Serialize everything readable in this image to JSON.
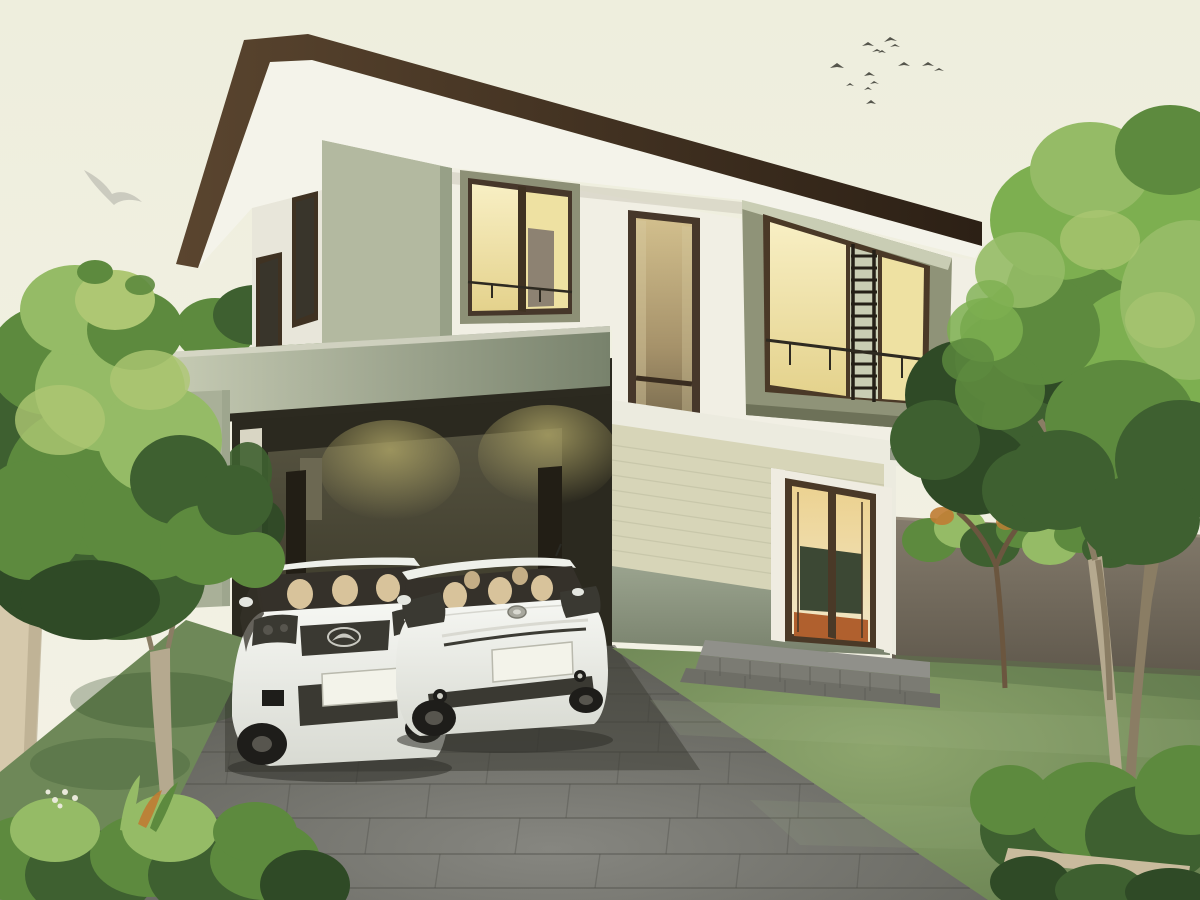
{
  "scene": {
    "type": "3d-architectural-rendering",
    "subject": "Modern two-story house exterior at dusk with carport, two white cars (Mazda SUV and Toyota Prius), block-paved driveway, front lawn, garden walls and trees; interior lights glowing warm yellow; birds flying in a pale cream sky",
    "objects": [
      "two-story-house",
      "hip-roof",
      "carport",
      "mazda-suv",
      "toyota-prius",
      "driveway",
      "front-lawn",
      "entrance-door",
      "entrance-steps",
      "boxed-window",
      "stairwell-window",
      "lit-window",
      "garden-wall",
      "boundary-wall",
      "left-tree",
      "right-trees",
      "hedges",
      "white-bird",
      "bird-flock"
    ],
    "palette": {
      "sky_base": "#f1f0e2",
      "bird_white": "#c6c6bb",
      "birds": "#3a3a33",
      "roof_brown_light": "#5a452f",
      "roof_brown_dark": "#2c2015",
      "soffit_white": "#f4f3ea",
      "wall_white": "#f1efe4",
      "wall_white_shade": "#e8e6da",
      "wall_sage": "#b3b9a0",
      "wall_sage_dark": "#97a087",
      "carport_band_light": "#c6cbb4",
      "carport_band_dark": "#78826c",
      "carport_band_fascia": "#2c2a20",
      "carport_band_cap": "#dad9c9",
      "carport_column": "#a9b098",
      "carport_interior": "#2b291f",
      "carport_back_wall": "#4b4937",
      "carport_door": "#221e15",
      "carport_window_frame": "#6c6852",
      "interior_light_wall": "#d9d6c4",
      "window_frame_dark": "#3f3222",
      "window_glass_dark": "#39352b",
      "window_frame_olive": "#8d9076",
      "window_box_sage": "#8f9378",
      "window_box_light": "#c9cdb4",
      "window_box_shade": "#6d7158",
      "window_glass_lit": "#eee1a2",
      "window_glass_lit_bright": "#f6ecc0",
      "window_interior_door": "#8d8272",
      "trellis_dark": "#241f17",
      "railing_dark": "#2e2a21",
      "tall_window_frame": "#46372a",
      "interfloor_shadow": "#c9c6b6",
      "siding_cream": "#d7d5b8",
      "siding_line": "#c2c0a4",
      "lower_band": "#96a08a",
      "lower_band_dark": "#7f8873",
      "corner_trim": "#ecebdf",
      "entrance_white": "#efece1",
      "entrance_frame": "#4a3927",
      "entrance_greenboard": "#3c4834",
      "entrance_floor": "#b0602e",
      "porch_top": "#90908a",
      "porch_face": "#7b7b73",
      "porch_face_low": "#6e6e66",
      "porch_joint": "#5e5e57",
      "driveway_joint": "#50504a",
      "driveway_shadow": "#3a3931",
      "grass_strip": "#6e8858",
      "grass_dark": "#5c744a",
      "grass_highlight": "#a8bd8a",
      "foliage_yellow": "#aec773",
      "foliage_light": "#95bb66",
      "foliage_fresh": "#7daf50",
      "foliage_mid": "#5d8a3e",
      "foliage_dark": "#3e6030",
      "foliage_deep": "#2f4a26",
      "trunk_light": "#b5a98f",
      "trunk_shade": "#8a7d64",
      "branch_brown": "#6b563f",
      "left_wall": "#d6c9ac",
      "left_wall_shade": "#b7a98d",
      "timber": "#c9bb9d",
      "accent_orange": "#bf7c33",
      "flower_white": "#e9e9da",
      "car_glass": "#35312a",
      "car_seat": "#d8c39b",
      "car_plate": "#f3f3ea",
      "car_grille": "#3a3932",
      "car_chrome": "#d9d9d1",
      "car_emblem": "#c9c9c1",
      "car_wheel": "#1e1d1a",
      "car_hub": "#57554e",
      "car_shadow": "#30302a",
      "shadow_soft": "#55533f"
    }
  }
}
